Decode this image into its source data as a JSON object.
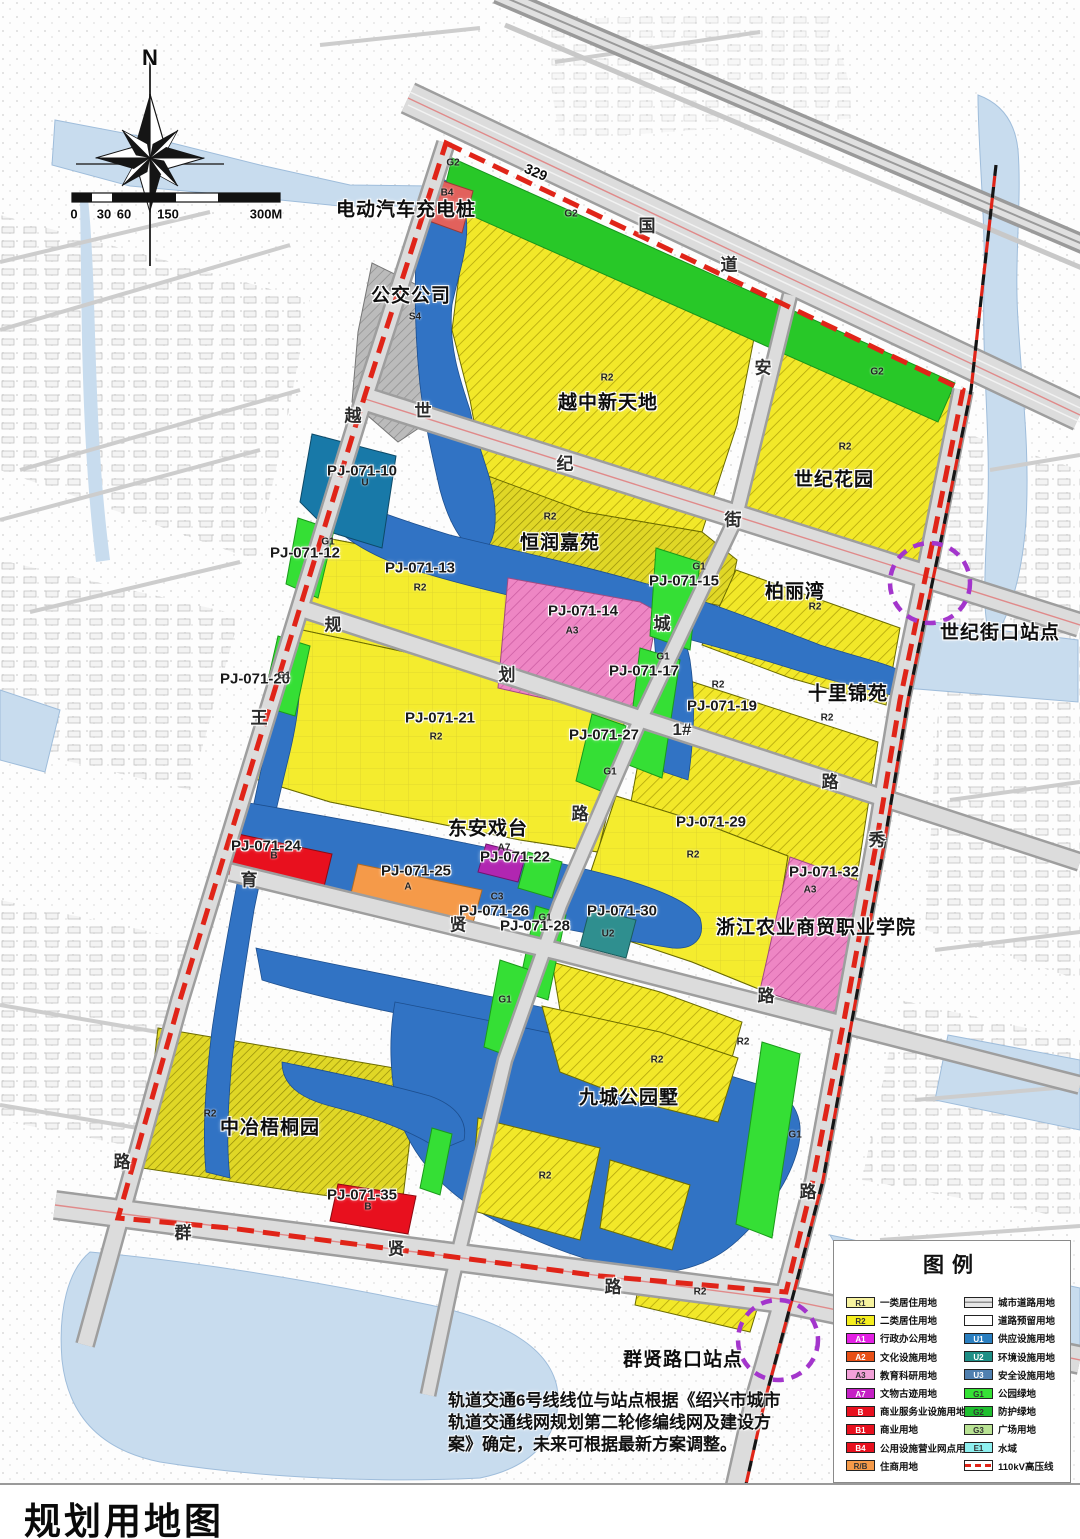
{
  "title": "规划用地图",
  "note": {
    "text": "轨道交通6号线线位与站点根据《绍兴市城市轨道交通线网规划第二轮修编线网及建设方案》确定，未来可根据最新方案调整。"
  },
  "colors": {
    "boundary_red": "#e02418",
    "water_blue": "#3173c4",
    "outside_water": "#c8dcee",
    "residential_yellow": "#f2e829",
    "park_green": "#35df35",
    "education_pink": "#ee86c4",
    "commercial_red": "#e8101e",
    "station_purple": "#a335cc"
  },
  "legend": {
    "title": "图例",
    "left": [
      {
        "code": "R1",
        "color": "#f7f3a0",
        "label": "一类居住用地"
      },
      {
        "code": "R2",
        "color": "#f5ee1e",
        "label": "二类居住用地"
      },
      {
        "code": "A1",
        "color": "#e320e3",
        "label": "行政办公用地",
        "tc": "#fff"
      },
      {
        "code": "A2",
        "color": "#e85016",
        "label": "文化设施用地",
        "tc": "#fff"
      },
      {
        "code": "A3",
        "color": "#f2a0d8",
        "label": "教育科研用地"
      },
      {
        "code": "A7",
        "color": "#c520c5",
        "label": "文物古迹用地",
        "tc": "#fff"
      },
      {
        "code": "B",
        "color": "#e8101e",
        "label": "商业服务业设施用地",
        "tc": "#fff"
      },
      {
        "code": "B1",
        "color": "#e8101e",
        "label": "商业用地",
        "tc": "#fff"
      },
      {
        "code": "B4",
        "color": "#e8101e",
        "label": "公用设施营业网点用地",
        "tc": "#fff"
      },
      {
        "code": "R/B",
        "color": "#f59a49",
        "label": "住商用地"
      }
    ],
    "right": [
      {
        "type": "road",
        "label": "城市道路用地"
      },
      {
        "type": "blank",
        "label": "道路预留用地"
      },
      {
        "code": "U1",
        "color": "#2a7fc0",
        "label": "供应设施用地",
        "tc": "#fff"
      },
      {
        "code": "U2",
        "color": "#1f8f86",
        "label": "环境设施用地",
        "tc": "#fff"
      },
      {
        "code": "U3",
        "color": "#5080b0",
        "label": "安全设施用地",
        "tc": "#fff"
      },
      {
        "code": "G1",
        "color": "#35e235",
        "label": "公园绿地"
      },
      {
        "code": "G2",
        "color": "#1fbf2f",
        "label": "防护绿地"
      },
      {
        "code": "G3",
        "color": "#b9e394",
        "label": "广场用地"
      },
      {
        "code": "E1",
        "color": "#8ff0f0",
        "label": "水域"
      },
      {
        "type": "dash",
        "label": "110kV高压线"
      }
    ]
  },
  "map": {
    "labels": [
      {
        "t": "N",
        "x": 150,
        "y": 58,
        "c": "north"
      },
      {
        "t": "0",
        "x": 74,
        "y": 214,
        "c": "scale"
      },
      {
        "t": "30",
        "x": 104,
        "y": 214,
        "c": "scale"
      },
      {
        "t": "60",
        "x": 124,
        "y": 214,
        "c": "scale"
      },
      {
        "t": "150",
        "x": 168,
        "y": 214,
        "c": "scale"
      },
      {
        "t": "300M",
        "x": 266,
        "y": 214,
        "c": "scale"
      },
      {
        "t": "电动汽车充电桩",
        "x": 406,
        "y": 208,
        "c": "place"
      },
      {
        "t": "公交公司",
        "x": 411,
        "y": 294,
        "c": "place"
      },
      {
        "t": "越中新天地",
        "x": 608,
        "y": 401,
        "c": "place"
      },
      {
        "t": "世纪花园",
        "x": 834,
        "y": 478,
        "c": "place"
      },
      {
        "t": "恒润嘉苑",
        "x": 560,
        "y": 541,
        "c": "place"
      },
      {
        "t": "柏丽湾",
        "x": 795,
        "y": 590,
        "c": "place"
      },
      {
        "t": "十里锦苑",
        "x": 848,
        "y": 692,
        "c": "place"
      },
      {
        "t": "东安戏台",
        "x": 488,
        "y": 827,
        "c": "place"
      },
      {
        "t": "浙江农业商贸职业学院",
        "x": 816,
        "y": 926,
        "c": "place"
      },
      {
        "t": "中冶梧桐园",
        "x": 270,
        "y": 1126,
        "c": "place"
      },
      {
        "t": "九城公园墅",
        "x": 629,
        "y": 1096,
        "c": "place"
      },
      {
        "t": "世纪街口站点",
        "x": 1000,
        "y": 631,
        "c": "place"
      },
      {
        "t": "群贤路口站点",
        "x": 683,
        "y": 1358,
        "c": "place"
      },
      {
        "t": "PJ-071-10",
        "x": 362,
        "y": 471,
        "c": "code"
      },
      {
        "t": "PJ-071-12",
        "x": 305,
        "y": 553,
        "c": "code"
      },
      {
        "t": "PJ-071-13",
        "x": 420,
        "y": 568,
        "c": "code"
      },
      {
        "t": "PJ-071-14",
        "x": 583,
        "y": 611,
        "c": "code"
      },
      {
        "t": "PJ-071-15",
        "x": 684,
        "y": 581,
        "c": "code"
      },
      {
        "t": "PJ-071-17",
        "x": 644,
        "y": 671,
        "c": "code"
      },
      {
        "t": "PJ-071-19",
        "x": 722,
        "y": 706,
        "c": "code"
      },
      {
        "t": "PJ-071-20",
        "x": 255,
        "y": 679,
        "c": "code"
      },
      {
        "t": "PJ-071-21",
        "x": 440,
        "y": 718,
        "c": "code"
      },
      {
        "t": "PJ-071-22",
        "x": 515,
        "y": 857,
        "c": "code"
      },
      {
        "t": "PJ-071-24",
        "x": 266,
        "y": 846,
        "c": "code"
      },
      {
        "t": "PJ-071-25",
        "x": 416,
        "y": 871,
        "c": "code"
      },
      {
        "t": "PJ-071-26",
        "x": 494,
        "y": 911,
        "c": "code"
      },
      {
        "t": "PJ-071-27",
        "x": 604,
        "y": 735,
        "c": "code"
      },
      {
        "t": "PJ-071-28",
        "x": 535,
        "y": 926,
        "c": "code"
      },
      {
        "t": "PJ-071-29",
        "x": 711,
        "y": 822,
        "c": "code"
      },
      {
        "t": "PJ-071-30",
        "x": 622,
        "y": 911,
        "c": "code"
      },
      {
        "t": "PJ-071-32",
        "x": 824,
        "y": 872,
        "c": "code"
      },
      {
        "t": "PJ-071-35",
        "x": 362,
        "y": 1195,
        "c": "code"
      },
      {
        "t": "329",
        "x": 536,
        "y": 172,
        "c": "r329"
      },
      {
        "t": "国",
        "x": 647,
        "y": 224,
        "c": "road"
      },
      {
        "t": "道",
        "x": 729,
        "y": 263,
        "c": "road"
      },
      {
        "t": "世",
        "x": 423,
        "y": 409,
        "c": "road"
      },
      {
        "t": "纪",
        "x": 565,
        "y": 462,
        "c": "road"
      },
      {
        "t": "街",
        "x": 733,
        "y": 518,
        "c": "road"
      },
      {
        "t": "越",
        "x": 353,
        "y": 414,
        "c": "road"
      },
      {
        "t": "王",
        "x": 259,
        "y": 716,
        "c": "road"
      },
      {
        "t": "路",
        "x": 122,
        "y": 1160,
        "c": "road"
      },
      {
        "t": "安",
        "x": 763,
        "y": 366,
        "c": "road"
      },
      {
        "t": "城",
        "x": 662,
        "y": 622,
        "c": "road"
      },
      {
        "t": "路",
        "x": 580,
        "y": 812,
        "c": "road"
      },
      {
        "t": "规",
        "x": 333,
        "y": 623,
        "c": "road"
      },
      {
        "t": "划",
        "x": 507,
        "y": 673,
        "c": "road"
      },
      {
        "t": "1#",
        "x": 682,
        "y": 730,
        "c": "road"
      },
      {
        "t": "路",
        "x": 830,
        "y": 780,
        "c": "road"
      },
      {
        "t": "育",
        "x": 249,
        "y": 878,
        "c": "road"
      },
      {
        "t": "贤",
        "x": 458,
        "y": 923,
        "c": "road"
      },
      {
        "t": "路",
        "x": 766,
        "y": 994,
        "c": "road"
      },
      {
        "t": "群",
        "x": 183,
        "y": 1231,
        "c": "road"
      },
      {
        "t": "贤",
        "x": 396,
        "y": 1247,
        "c": "road"
      },
      {
        "t": "路",
        "x": 613,
        "y": 1285,
        "c": "road"
      },
      {
        "t": "秀",
        "x": 877,
        "y": 838,
        "c": "road"
      },
      {
        "t": "路",
        "x": 808,
        "y": 1190,
        "c": "road"
      },
      {
        "t": "G2",
        "x": 453,
        "y": 163,
        "c": "zone"
      },
      {
        "t": "B4",
        "x": 447,
        "y": 193,
        "c": "zone"
      },
      {
        "t": "G2",
        "x": 571,
        "y": 214,
        "c": "zone"
      },
      {
        "t": "S4",
        "x": 415,
        "y": 317,
        "c": "zone"
      },
      {
        "t": "R2",
        "x": 607,
        "y": 378,
        "c": "zone"
      },
      {
        "t": "G2",
        "x": 877,
        "y": 372,
        "c": "zone"
      },
      {
        "t": "R2",
        "x": 845,
        "y": 447,
        "c": "zone"
      },
      {
        "t": "U",
        "x": 365,
        "y": 483,
        "c": "zone"
      },
      {
        "t": "G1",
        "x": 328,
        "y": 542,
        "c": "zone"
      },
      {
        "t": "R2",
        "x": 420,
        "y": 588,
        "c": "zone"
      },
      {
        "t": "R2",
        "x": 550,
        "y": 517,
        "c": "zone"
      },
      {
        "t": "R2",
        "x": 815,
        "y": 607,
        "c": "zone"
      },
      {
        "t": "A3",
        "x": 572,
        "y": 631,
        "c": "zone"
      },
      {
        "t": "G1",
        "x": 699,
        "y": 567,
        "c": "zone"
      },
      {
        "t": "G1",
        "x": 663,
        "y": 657,
        "c": "zone"
      },
      {
        "t": "R2",
        "x": 718,
        "y": 685,
        "c": "zone"
      },
      {
        "t": "G1",
        "x": 284,
        "y": 676,
        "c": "zone"
      },
      {
        "t": "R2",
        "x": 436,
        "y": 737,
        "c": "zone"
      },
      {
        "t": "R2",
        "x": 827,
        "y": 718,
        "c": "zone"
      },
      {
        "t": "G1",
        "x": 610,
        "y": 772,
        "c": "zone"
      },
      {
        "t": "B",
        "x": 274,
        "y": 856,
        "c": "zone"
      },
      {
        "t": "A7",
        "x": 504,
        "y": 848,
        "c": "zone"
      },
      {
        "t": "G1",
        "x": 545,
        "y": 918,
        "c": "zone"
      },
      {
        "t": "A",
        "x": 408,
        "y": 887,
        "c": "zone"
      },
      {
        "t": "C3",
        "x": 497,
        "y": 897,
        "c": "zone"
      },
      {
        "t": "U2",
        "x": 608,
        "y": 934,
        "c": "zone"
      },
      {
        "t": "R2",
        "x": 693,
        "y": 855,
        "c": "zone"
      },
      {
        "t": "A3",
        "x": 810,
        "y": 890,
        "c": "zone"
      },
      {
        "t": "G1",
        "x": 505,
        "y": 1000,
        "c": "zone"
      },
      {
        "t": "R2",
        "x": 743,
        "y": 1042,
        "c": "zone"
      },
      {
        "t": "R2",
        "x": 657,
        "y": 1060,
        "c": "zone"
      },
      {
        "t": "G1",
        "x": 795,
        "y": 1135,
        "c": "zone"
      },
      {
        "t": "R2",
        "x": 210,
        "y": 1114,
        "c": "zone"
      },
      {
        "t": "R2",
        "x": 545,
        "y": 1176,
        "c": "zone"
      },
      {
        "t": "B",
        "x": 368,
        "y": 1207,
        "c": "zone"
      },
      {
        "t": "R2",
        "x": 700,
        "y": 1292,
        "c": "zone"
      }
    ]
  }
}
